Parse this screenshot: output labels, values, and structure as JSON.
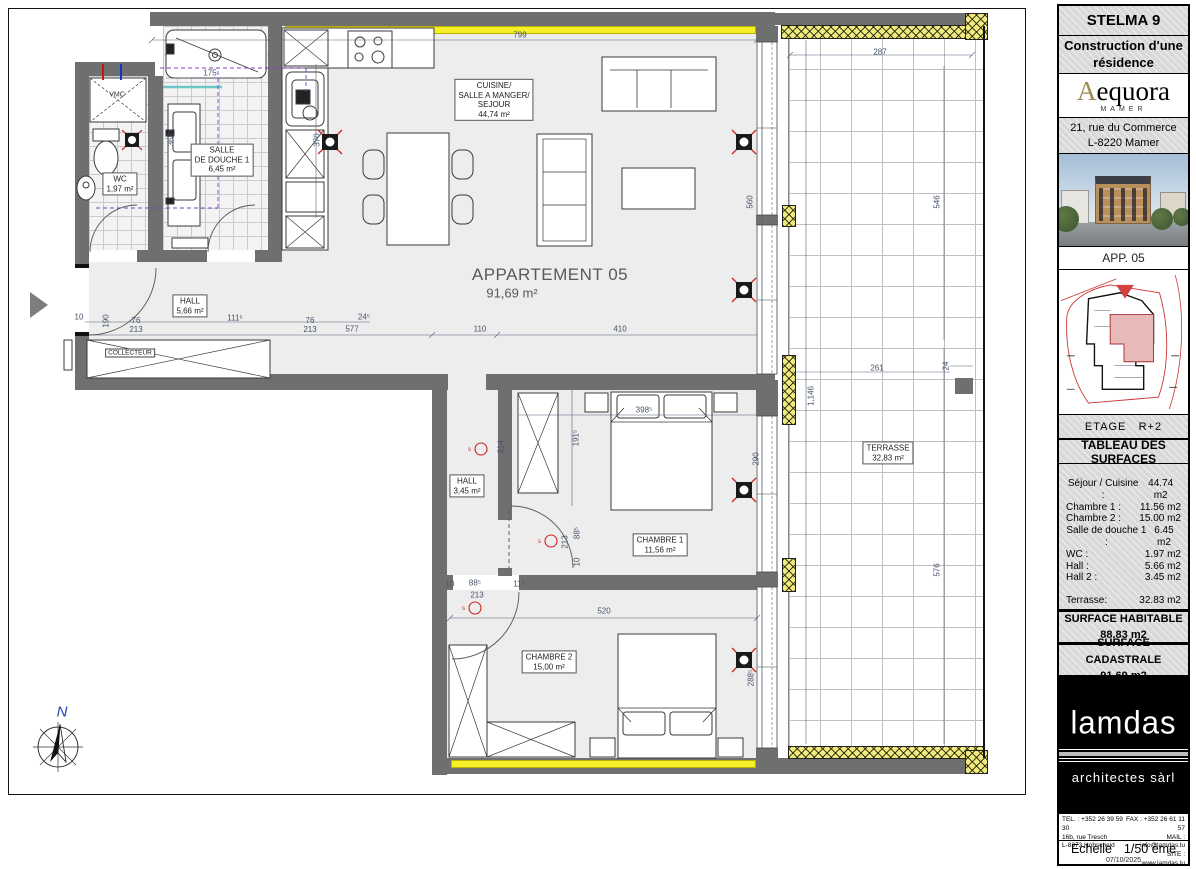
{
  "title_block": {
    "project": "STELMA 9",
    "subtitle": "Construction d'une\nrésidence",
    "brand": {
      "initial": "A",
      "rest": "equora",
      "sub": "MAMER"
    },
    "address": "21, rue du Commerce\nL-8220  Mamer",
    "app": "APP. 05",
    "etage_label": "ETAGE",
    "etage_value": "R+2",
    "tableau_title": "TABLEAU DES SURFACES",
    "surfaces": [
      {
        "label": "Séjour / Cuisine :",
        "value": "44.74 m2"
      },
      {
        "label": "Chambre 1 :",
        "value": "11.56 m2"
      },
      {
        "label": "Chambre 2 :",
        "value": "15.00 m2"
      },
      {
        "label": "Salle de douche 1 :",
        "value": "6.45 m2"
      },
      {
        "label": "WC :",
        "value": "1.97 m2"
      },
      {
        "label": "Hall :",
        "value": "5.66 m2"
      },
      {
        "label": "Hall 2 :",
        "value": "3.45 m2"
      },
      {
        "label": "Terrasse:",
        "value": "32.83 m2",
        "gap": true
      }
    ],
    "habitable_label": "SURFACE  HABITABLE",
    "habitable_value": "88.83  m2",
    "cadastrale_label": "SURFACE  CADASTRALE",
    "cadastrale_value": "91.69  m2",
    "logo": {
      "name": "lamdas",
      "sub": "architectes sàrl"
    },
    "contact": {
      "tel": "TEL. : +352 26 39 59 30",
      "addr1": "16b, rue Tresch",
      "addr2": "L-8373 Hobscheid",
      "fax": "FAX : +352 26 61 11 57",
      "mail": "MAIL : info@lamdas.lu",
      "site": "SITE : www.lamdas.lu"
    },
    "echelle_label": "Echelle",
    "echelle_value": "1/50 ème",
    "date": "07/10/2025"
  },
  "plan": {
    "labels": [
      {
        "t": "CUISINE/\nSALLE A MANGER/\nSEJOUR\n44,74 m²",
        "x": 494,
        "y": 100,
        "cls": "boxed",
        "n": "room-label-sejour"
      },
      {
        "t": "SALLE\nDE DOUCHE 1\n6,45 m²",
        "x": 222,
        "y": 160,
        "cls": "boxed",
        "n": "room-label-salle-de-douche"
      },
      {
        "t": "WC\n1,97 m²",
        "x": 120,
        "y": 184,
        "cls": "boxed",
        "n": "room-label-wc"
      },
      {
        "t": "HALL\n5,66 m²",
        "x": 190,
        "y": 306,
        "cls": "boxed",
        "n": "room-label-hall"
      },
      {
        "t": "HALL\n3,45 m²",
        "x": 467,
        "y": 486,
        "cls": "boxed",
        "n": "room-label-hall2"
      },
      {
        "t": "CHAMBRE 1\n11,56 m²",
        "x": 660,
        "y": 545,
        "cls": "boxed",
        "n": "room-label-chambre1"
      },
      {
        "t": "CHAMBRE 2\n15,00 m²",
        "x": 549,
        "y": 662,
        "cls": "boxed",
        "n": "room-label-chambre2"
      },
      {
        "t": "TERRASSE\n32,83 m²",
        "x": 888,
        "y": 453,
        "cls": "boxed",
        "n": "room-label-terrasse"
      },
      {
        "t": "APPARTEMENT 05",
        "x": 550,
        "y": 275,
        "cls": "big",
        "n": "apartment-title"
      },
      {
        "t": "91,69 m²",
        "x": 512,
        "y": 293,
        "cls": "big2",
        "n": "apartment-area"
      },
      {
        "t": "VMC",
        "x": 117,
        "y": 95,
        "cls": "tiny",
        "n": "vmc-label"
      },
      {
        "t": "COLLECTEUR",
        "x": 130,
        "y": 353,
        "cls": "tinybox",
        "n": "collecteur-label"
      },
      {
        "t": "N",
        "x": 62,
        "y": 712,
        "cls": "north",
        "n": "north-label"
      }
    ],
    "dims": [
      {
        "t": "799",
        "x": 520,
        "y": 36
      },
      {
        "t": "287",
        "x": 880,
        "y": 53
      },
      {
        "t": "175",
        "x": 210,
        "y": 74
      },
      {
        "t": "368⁵",
        "x": 172,
        "y": 138,
        "r": 1
      },
      {
        "t": "370",
        "x": 318,
        "y": 140,
        "r": 1
      },
      {
        "t": "560",
        "x": 751,
        "y": 202,
        "r": 1
      },
      {
        "t": "546",
        "x": 938,
        "y": 202,
        "r": 1
      },
      {
        "t": "10",
        "x": 79,
        "y": 318
      },
      {
        "t": "76\n213",
        "x": 136,
        "y": 326
      },
      {
        "t": "111⁵",
        "x": 235,
        "y": 319
      },
      {
        "t": "76\n213",
        "x": 310,
        "y": 326
      },
      {
        "t": "24⁵",
        "x": 364,
        "y": 318
      },
      {
        "t": "190",
        "x": 107,
        "y": 321,
        "r": 1
      },
      {
        "t": "577",
        "x": 352,
        "y": 330
      },
      {
        "t": "110",
        "x": 480,
        "y": 330
      },
      {
        "t": "410",
        "x": 620,
        "y": 330
      },
      {
        "t": "261",
        "x": 877,
        "y": 369
      },
      {
        "t": "24",
        "x": 947,
        "y": 366,
        "r": 1
      },
      {
        "t": "1,146",
        "x": 812,
        "y": 396,
        "r": 1
      },
      {
        "t": "398⁵",
        "x": 644,
        "y": 411
      },
      {
        "t": "314",
        "x": 502,
        "y": 447,
        "r": 1
      },
      {
        "t": "191⁵",
        "x": 577,
        "y": 438,
        "r": 1
      },
      {
        "t": "290",
        "x": 757,
        "y": 459,
        "r": 1
      },
      {
        "t": "213",
        "x": 566,
        "y": 542,
        "r": 1
      },
      {
        "t": "88⁵",
        "x": 578,
        "y": 533,
        "r": 1
      },
      {
        "t": "10",
        "x": 578,
        "y": 562,
        "r": 1
      },
      {
        "t": "10",
        "x": 450,
        "y": 585
      },
      {
        "t": "88⁵",
        "x": 475,
        "y": 584
      },
      {
        "t": "213",
        "x": 477,
        "y": 596
      },
      {
        "t": "11⁵",
        "x": 519,
        "y": 585
      },
      {
        "t": "520",
        "x": 604,
        "y": 612
      },
      {
        "t": "288⁵",
        "x": 752,
        "y": 678,
        "r": 1
      },
      {
        "t": "576",
        "x": 938,
        "y": 570,
        "r": 1
      }
    ]
  }
}
